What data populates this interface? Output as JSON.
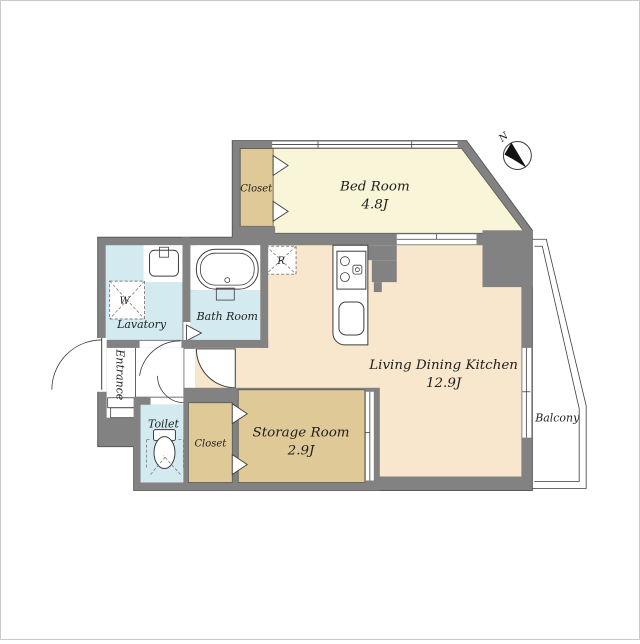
{
  "colors": {
    "wall": "#828282",
    "wall_edge": "#595959",
    "line": "#3d3d3d",
    "text": "#1f1f1f",
    "bedroom_floor": "#f9f5d8",
    "ldk_floor": "#f8e7cd",
    "closet_floor": "#dfc996",
    "wet_floor": "#d2eaf0"
  },
  "rooms": {
    "bedroom": {
      "label": "Bed Room",
      "area": "4.8J"
    },
    "ldk": {
      "label": "Living Dining Kitchen",
      "area": "12.9J"
    },
    "storage": {
      "label": "Storage Room",
      "area": "2.9J"
    },
    "bedroom_closet": {
      "label": "Closet"
    },
    "hall_closet": {
      "label": "Closet"
    },
    "lavatory": {
      "label": "Lavatory"
    },
    "bathroom": {
      "label": "Bath Room"
    },
    "toilet": {
      "label": "Toilet"
    },
    "entrance": {
      "label": "Entrance"
    },
    "balcony": {
      "label": "Balcony"
    }
  },
  "symbols": {
    "washing_machine": "W",
    "refrigerator": "R",
    "compass_north": "N"
  }
}
